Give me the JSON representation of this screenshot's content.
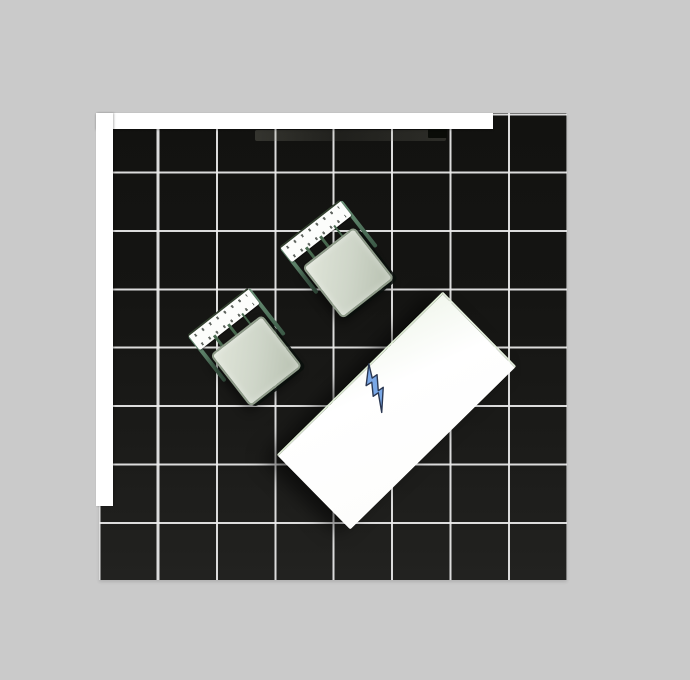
{
  "scene": {
    "type": "top-down-room-render",
    "background_color": "#cacaca",
    "floor": {
      "fill_dark": "#141412",
      "fill_light": "#222220",
      "grid_line_color": "#ebebeb",
      "grid_columns": 8,
      "grid_rows": 8,
      "grid_cell_px": 58.4
    },
    "walls": {
      "color": "#ffffff",
      "segments": [
        "top",
        "left"
      ]
    },
    "counter_strip": {
      "color": "rgba(150,150,135,0.2)"
    },
    "wall_object": {
      "color": "#0a0c08"
    },
    "objects": {
      "chair_1": {
        "label": "chair",
        "rotation_deg": -38,
        "center_x": 339,
        "center_y": 261,
        "seat_color": "#cfd6c9",
        "backrest_color": "#fcfdfb",
        "frame_color": "#4a6b51"
      },
      "chair_2": {
        "label": "chair",
        "rotation_deg": -38,
        "center_x": 247,
        "center_y": 349,
        "seat_color": "#cfd6c9",
        "backrest_color": "#fcfdfb",
        "frame_color": "#4a6b51"
      },
      "table": {
        "label": "table",
        "rotation_deg": -44.5,
        "center_x": 395,
        "center_y": 410,
        "top_color": "#fdfdfc",
        "edge_tint": "#dcead2"
      },
      "power_icon": {
        "label": "lightning-bolt",
        "fill": "#7aa8e6",
        "outline": "#2a3752",
        "center_x": 378,
        "center_y": 389
      }
    }
  }
}
